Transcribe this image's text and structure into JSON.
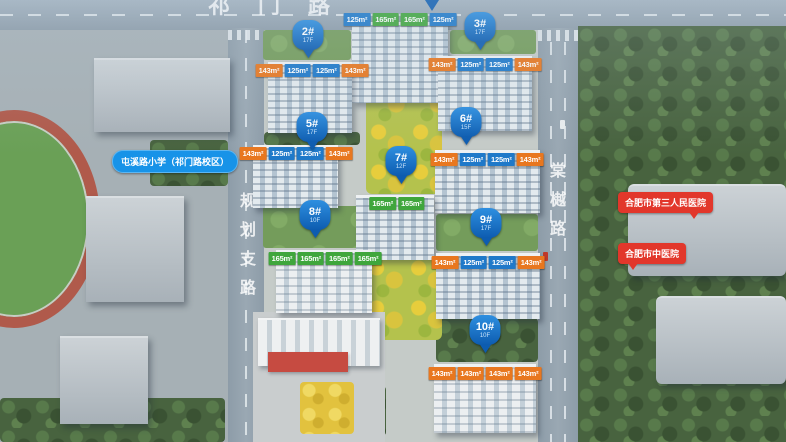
{
  "roads": {
    "top_label": "祁门路",
    "left_label": "规划支路",
    "right_label": "棠樾路"
  },
  "landmarks": {
    "school_label": "屯溪路小学（祁门路校区）",
    "hospital_third_label": "合肥市第三人民医院",
    "hospital_tcm_label": "合肥市中医院"
  },
  "pins": [
    {
      "label": "2#",
      "floors": "17F"
    },
    {
      "label": "3#",
      "floors": "17F"
    },
    {
      "label": "5#",
      "floors": "17F"
    },
    {
      "label": "6#",
      "floors": "15F"
    },
    {
      "label": "7#",
      "floors": "12F"
    },
    {
      "label": "8#",
      "floors": "10F"
    },
    {
      "label": "9#",
      "floors": "17F"
    },
    {
      "label": "10#",
      "floors": "10F"
    }
  ],
  "unit_tags": {
    "b1": [
      {
        "t": "125m²",
        "c": "blue"
      },
      {
        "t": "165m²",
        "c": "green"
      },
      {
        "t": "165m²",
        "c": "green"
      },
      {
        "t": "125m²",
        "c": "blue"
      }
    ],
    "b2": [
      {
        "t": "143m²",
        "c": "orange"
      },
      {
        "t": "125m²",
        "c": "blue"
      },
      {
        "t": "125m²",
        "c": "blue"
      },
      {
        "t": "143m²",
        "c": "orange"
      }
    ],
    "b3": [
      {
        "t": "143m²",
        "c": "orange"
      },
      {
        "t": "125m²",
        "c": "blue"
      },
      {
        "t": "125m²",
        "c": "blue"
      },
      {
        "t": "143m²",
        "c": "orange"
      }
    ],
    "b5": [
      {
        "t": "143m²",
        "c": "orange"
      },
      {
        "t": "125m²",
        "c": "blue"
      },
      {
        "t": "125m²",
        "c": "blue"
      },
      {
        "t": "143m²",
        "c": "orange"
      }
    ],
    "b6": [
      {
        "t": "143m²",
        "c": "orange"
      },
      {
        "t": "125m²",
        "c": "blue"
      },
      {
        "t": "125m²",
        "c": "blue"
      },
      {
        "t": "143m²",
        "c": "orange"
      }
    ],
    "b7": [
      {
        "t": "165m²",
        "c": "green"
      },
      {
        "t": "165m²",
        "c": "green"
      }
    ],
    "b8": [
      {
        "t": "165m²",
        "c": "green"
      },
      {
        "t": "165m²",
        "c": "green"
      },
      {
        "t": "165m²",
        "c": "green"
      },
      {
        "t": "165m²",
        "c": "green"
      }
    ],
    "b9": [
      {
        "t": "143m²",
        "c": "orange"
      },
      {
        "t": "125m²",
        "c": "blue"
      },
      {
        "t": "125m²",
        "c": "blue"
      },
      {
        "t": "143m²",
        "c": "orange"
      }
    ],
    "b10": [
      {
        "t": "143m²",
        "c": "orange"
      },
      {
        "t": "143m²",
        "c": "orange"
      },
      {
        "t": "143m²",
        "c": "orange"
      },
      {
        "t": "143m²",
        "c": "orange"
      }
    ]
  },
  "colors": {
    "pin_blue": "#0d5cb0",
    "tag_orange": "#e8771f",
    "tag_blue": "#1f79c9",
    "tag_green": "#3fa63c",
    "landmark_red": "#e2372b",
    "landmark_blue": "#1793e8",
    "park_yellow": "#e7cd3c",
    "road_gray": "#93a2ae"
  }
}
